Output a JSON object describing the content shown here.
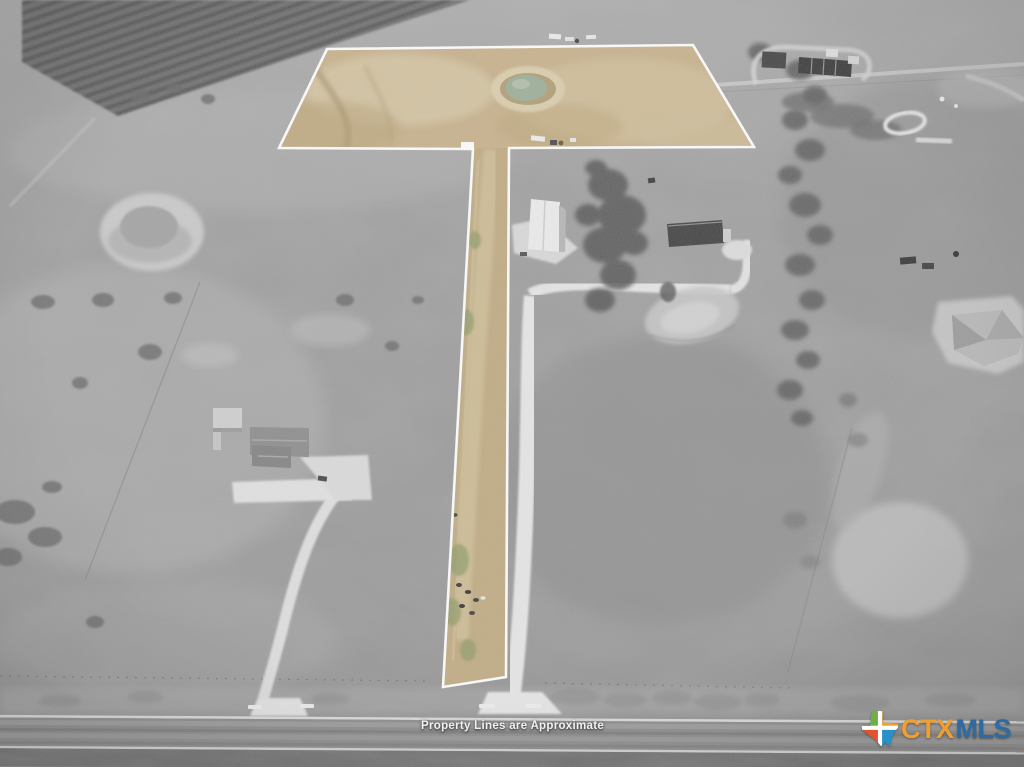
{
  "image": {
    "kind": "aerial-drone-photo",
    "subject": "Rural acreage listing photo; grayscale surroundings with color-highlighted flag-shaped parcel outlined in white",
    "width_px": 1024,
    "height_px": 767
  },
  "overlay": {
    "disclaimer": "Property Lines are Approximate",
    "disclaimer_color": "#ffffff",
    "parcel_outline_color": "#ffffff",
    "parcel_highlight_color": "#c8b28c",
    "parcel_pond_color": "#9fb09b",
    "surroundings_style": "desaturated-grayscale"
  },
  "logo": {
    "name": "CTXMLS",
    "prefix": "CTX",
    "suffix": "MLS",
    "prefix_color": "#f09e2e",
    "suffix_color": "#2d6ba3",
    "icon": "texas-state-icon",
    "icon_colors": {
      "top_left": "#6fb045",
      "top_right": "#f1a12f",
      "bottom_left": "#e1522e",
      "bottom_right": "#2791c9",
      "cross": "#ffffff"
    }
  },
  "scene": {
    "features": [
      "flag-shaped-parcel-with-pond",
      "access-strip-with-cattle",
      "plowed-field-top-left",
      "pond-left",
      "house-left-with-driveway",
      "white-roof-house-right",
      "dark-roof-barn-right",
      "tree-line-right",
      "farmstead-top-right",
      "paved-road-bottom"
    ]
  }
}
